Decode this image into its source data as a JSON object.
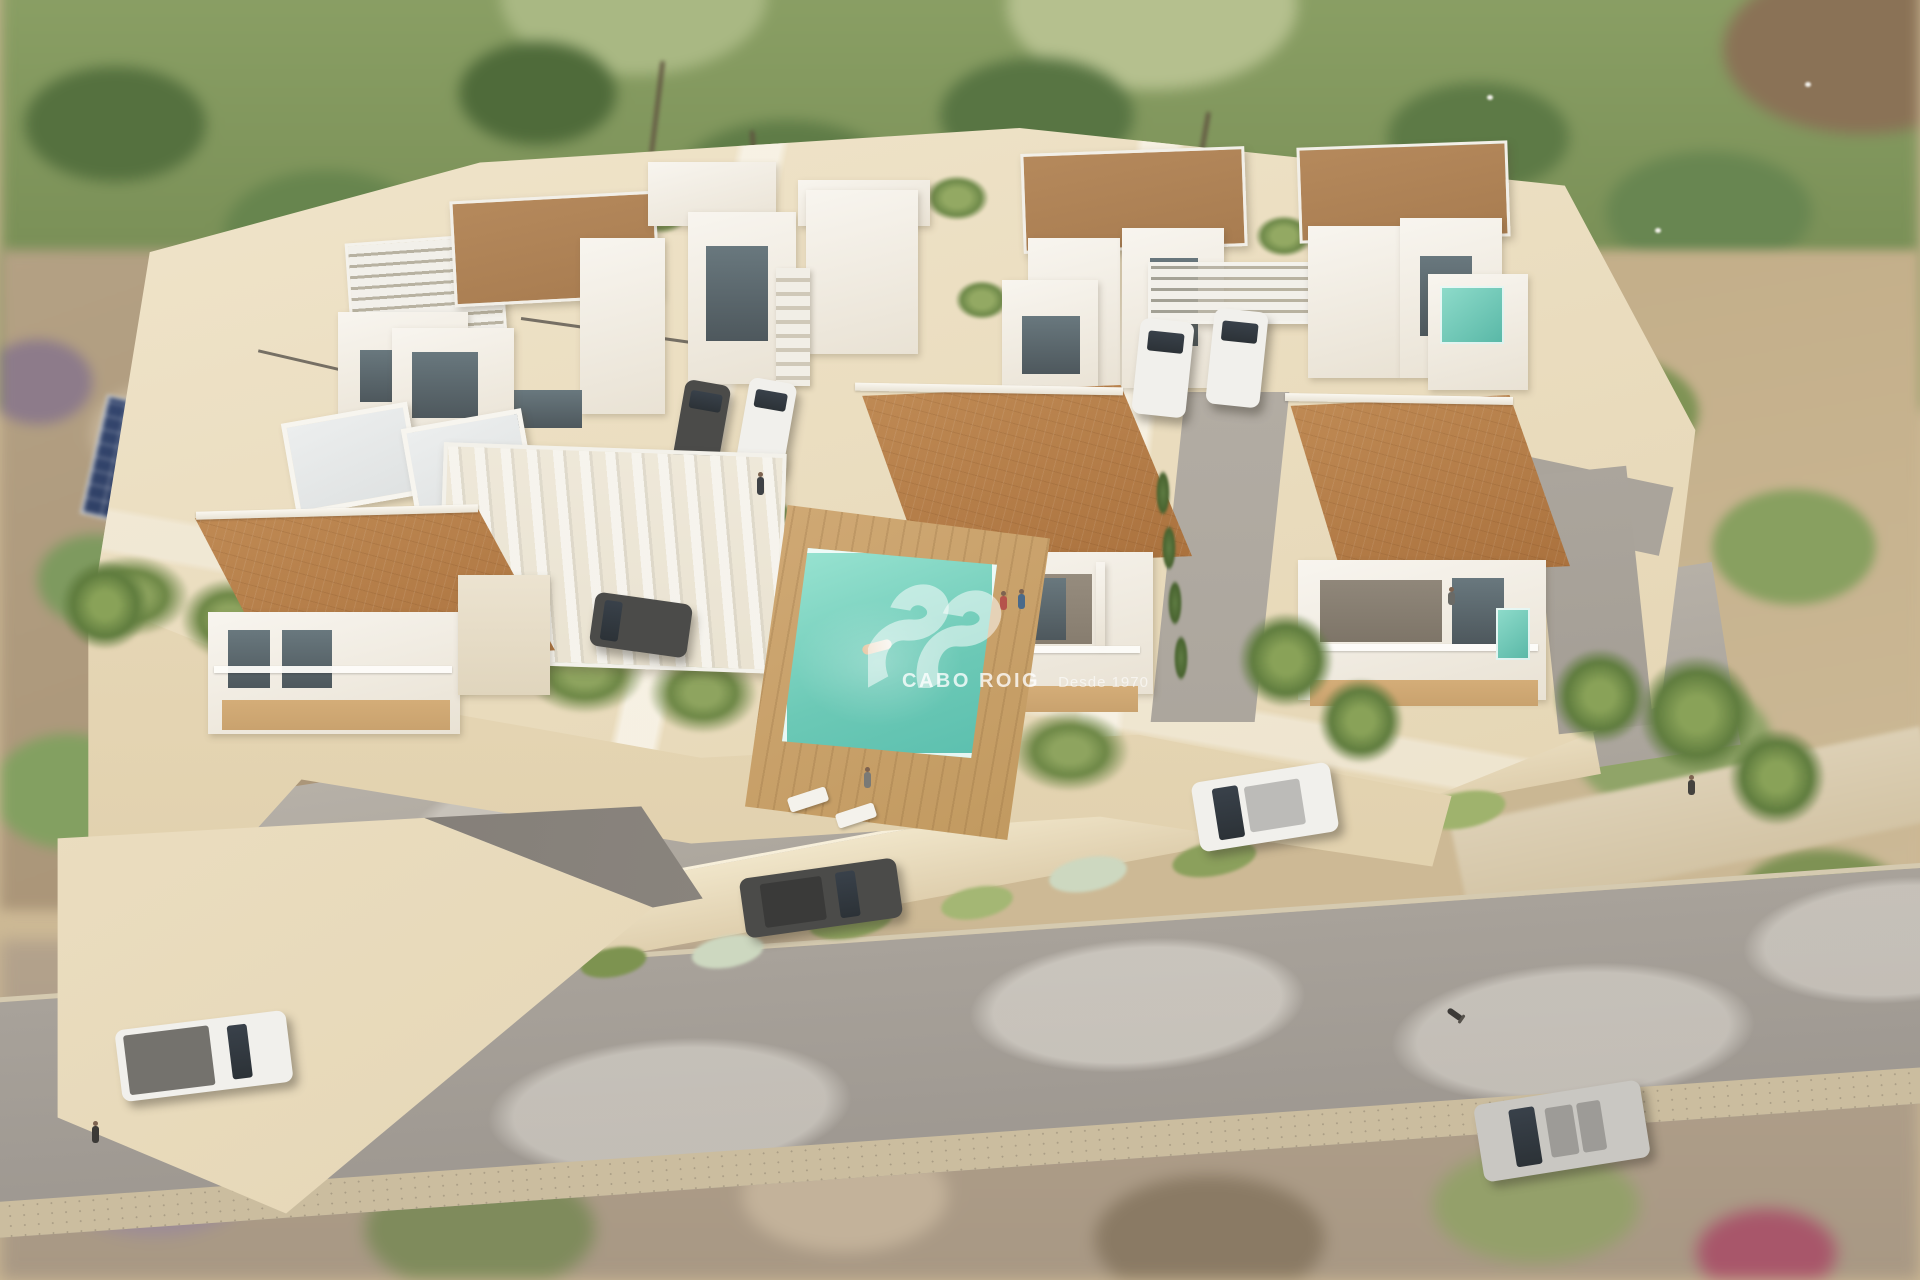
{
  "watermark": {
    "logo_icon": "sis-swoosh-icon",
    "brand": "CABO ROIG",
    "tagline": "Desde 1970"
  },
  "palette": {
    "sand": "#cdb995",
    "podium": "#e6d7b6",
    "wall": "#dccaa4",
    "wallDark": "#dfcfae",
    "white": "#f8f5ef",
    "terracotta": "#aa713d",
    "flatRoof": "#a87c50",
    "pool": "#6cc9b6",
    "neighborPool": "#5e89ab",
    "solar": "#2c3c60",
    "innerRoad": "#b6b0a7",
    "outerRoad": "#a8a29a",
    "ramp": "#7d7872",
    "deck": "#c9a26e",
    "glass": "#4e585d",
    "carDark": "#4b4b49",
    "carWhite": "#f1f0ec",
    "carSilver": "#c9c7c2"
  },
  "scene": {
    "type": "aerial-architectural-render",
    "counts": {
      "terracotta_roof_villas": 3,
      "flat_roof_houses": 4,
      "pools_visible": 4,
      "cars_visible": 9,
      "cyclists": 1
    }
  }
}
